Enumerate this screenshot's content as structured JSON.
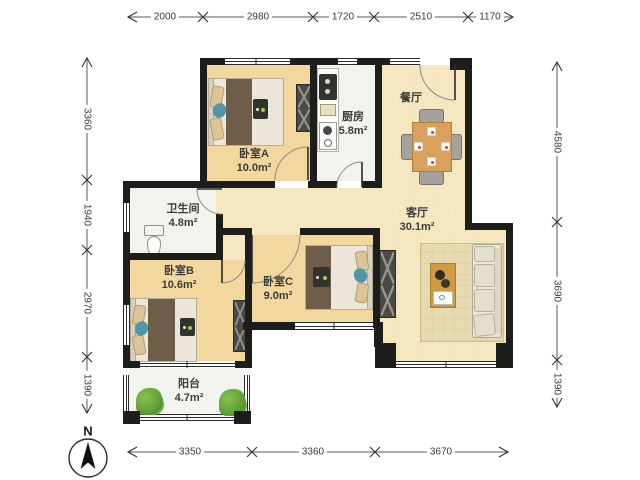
{
  "rooms": [
    {
      "id": "bedroom-a",
      "label": "卧室A",
      "area": "10.0m²"
    },
    {
      "id": "kitchen",
      "label": "厨房",
      "area": "5.8m²"
    },
    {
      "id": "dining",
      "label": "餐厅",
      "area": ""
    },
    {
      "id": "living",
      "label": "客厅",
      "area": "30.1m²"
    },
    {
      "id": "bathroom",
      "label": "卫生间",
      "area": "4.8m²"
    },
    {
      "id": "bedroom-b",
      "label": "卧室B",
      "area": "10.6m²"
    },
    {
      "id": "bedroom-c",
      "label": "卧室C",
      "area": "9.0m²"
    },
    {
      "id": "balcony",
      "label": "阳台",
      "area": "4.7m²"
    }
  ],
  "dimensions": {
    "top": [
      "2000",
      "2980",
      "1720",
      "2510",
      "1170"
    ],
    "bottom": [
      "3350",
      "3360",
      "3670"
    ],
    "left": [
      "3360",
      "1940",
      "2970",
      "1390"
    ],
    "right": [
      "4580",
      "3690",
      "1390"
    ]
  },
  "compass": {
    "label": "N"
  },
  "colors": {
    "wall": "#1d1d1b",
    "floor_bedroom": "#f2d89e",
    "floor_living": "#f5e7c0",
    "floor_tile": "#f3f3ee",
    "table_wood": "#d9a25c",
    "plant_green": "#5a9e34",
    "bed_blanket": "#6f5d49"
  }
}
